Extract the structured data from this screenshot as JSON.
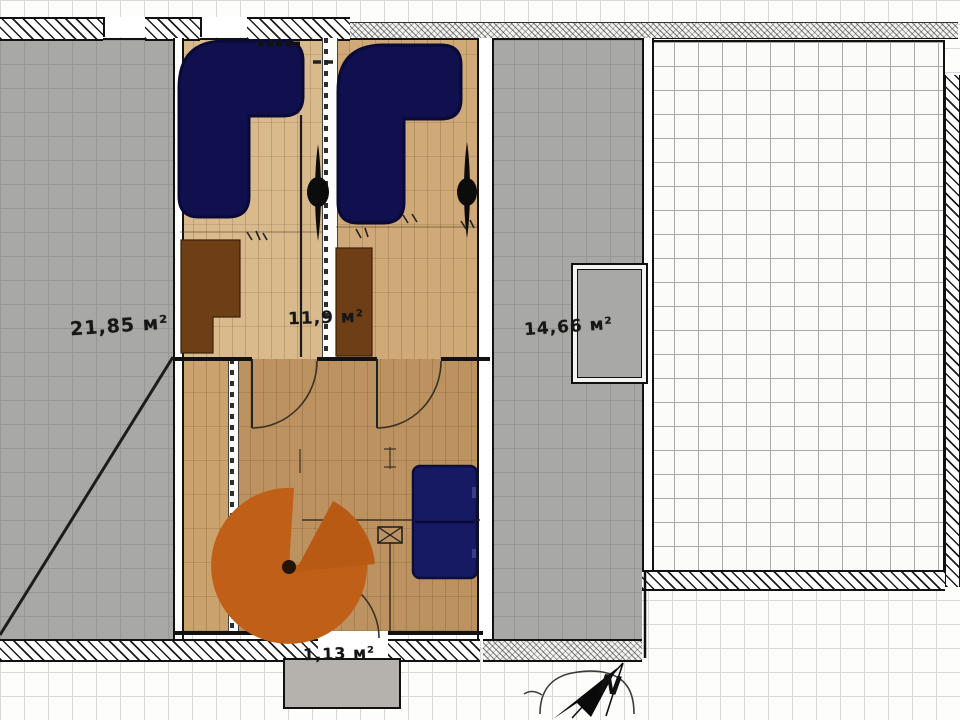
{
  "plan": {
    "labels": {
      "room_left_area": "21,85 м²",
      "room_top_middle_area": "11,9 м²",
      "room_right_area": "14,66 м²",
      "balcony_area": "1,13 м²"
    },
    "compass": {
      "north_label": "N"
    },
    "colors": {
      "sofa_navy": "#10104e",
      "bed_navy": "#151a63",
      "wardrobe_brown": "#6e3f16",
      "table_orange": "#c05f17",
      "table_slice_orange": "#b85a14",
      "fan_black": "#0c0c0c",
      "line_dark": "#1c1c1c"
    }
  }
}
